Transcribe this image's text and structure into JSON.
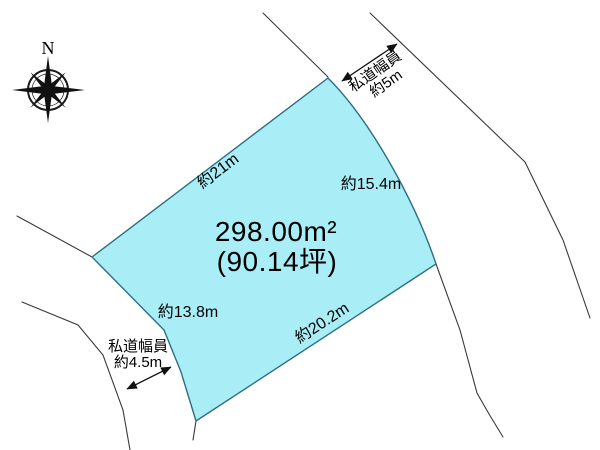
{
  "compass": {
    "north": "N"
  },
  "parcel": {
    "fill": "#a9edf7",
    "area_m2": "298.00m²",
    "area_tsubo": "(90.14坪)",
    "edge_labels": {
      "northwest": "約21m",
      "east": "約15.4m",
      "southwest": "約13.8m",
      "south": "約20.2m"
    }
  },
  "road_widths": {
    "northeast": {
      "title": "私道幅員",
      "value": "約5m"
    },
    "southwest": {
      "title": "私道幅員",
      "value": "約4.5m"
    }
  }
}
